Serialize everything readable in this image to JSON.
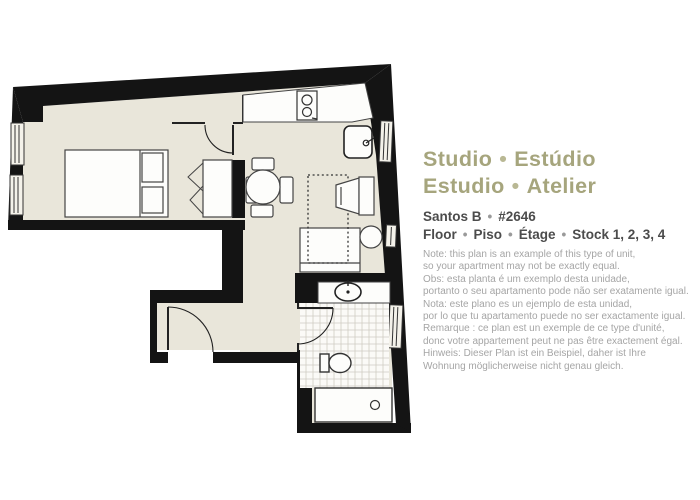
{
  "header": {
    "sep": "•",
    "title1a": "Studio",
    "title1b": "Estúdio",
    "title2a": "Estudio",
    "title2b": "Atelier",
    "building": "Santos B",
    "unit": "#2646",
    "floor1": "Floor",
    "floor2": "Piso",
    "floor3": "Étage",
    "floor4": "Stock 1, 2, 3, 4"
  },
  "note": {
    "lines": [
      "Note: this plan is an example of this type of unit,",
      "so your apartment may not be exactly equal.",
      "Obs: esta planta é um exemplo desta unidade,",
      "portanto o seu apartamento pode não ser exatamente igual.",
      "Nota: este plano es un ejemplo de esta unidad,",
      "por lo que tu apartamento puede no ser exactamente igual.",
      "Remarque : ce plan est un exemple de ce type d'unité,",
      "donc votre appartement peut ne pas être exactement égal.",
      "Hinweis: Dieser Plan ist ein Beispiel, daher ist Ihre",
      "Wohnung möglicherweise nicht genau gleich."
    ]
  },
  "colors": {
    "title_olive": "#a6a57d",
    "text_dark": "#4c4c4c",
    "note_gray": "#a5a5a5",
    "floor_beige": "#e9e6da",
    "wall_black": "#141414",
    "tile_grid": "#cfccc3"
  },
  "floorplan": {
    "fixtures": [
      "double-bed",
      "wardrobe",
      "dining-table",
      "dining-chairs",
      "kitchen-counter",
      "stove",
      "kitchen-sink",
      "sofa",
      "sofa-bed-outline",
      "armchair",
      "side-table",
      "bathroom-vanity-sink",
      "toilet",
      "shower",
      "entry-door",
      "bedroom-door",
      "bathroom-door",
      "windows"
    ]
  }
}
